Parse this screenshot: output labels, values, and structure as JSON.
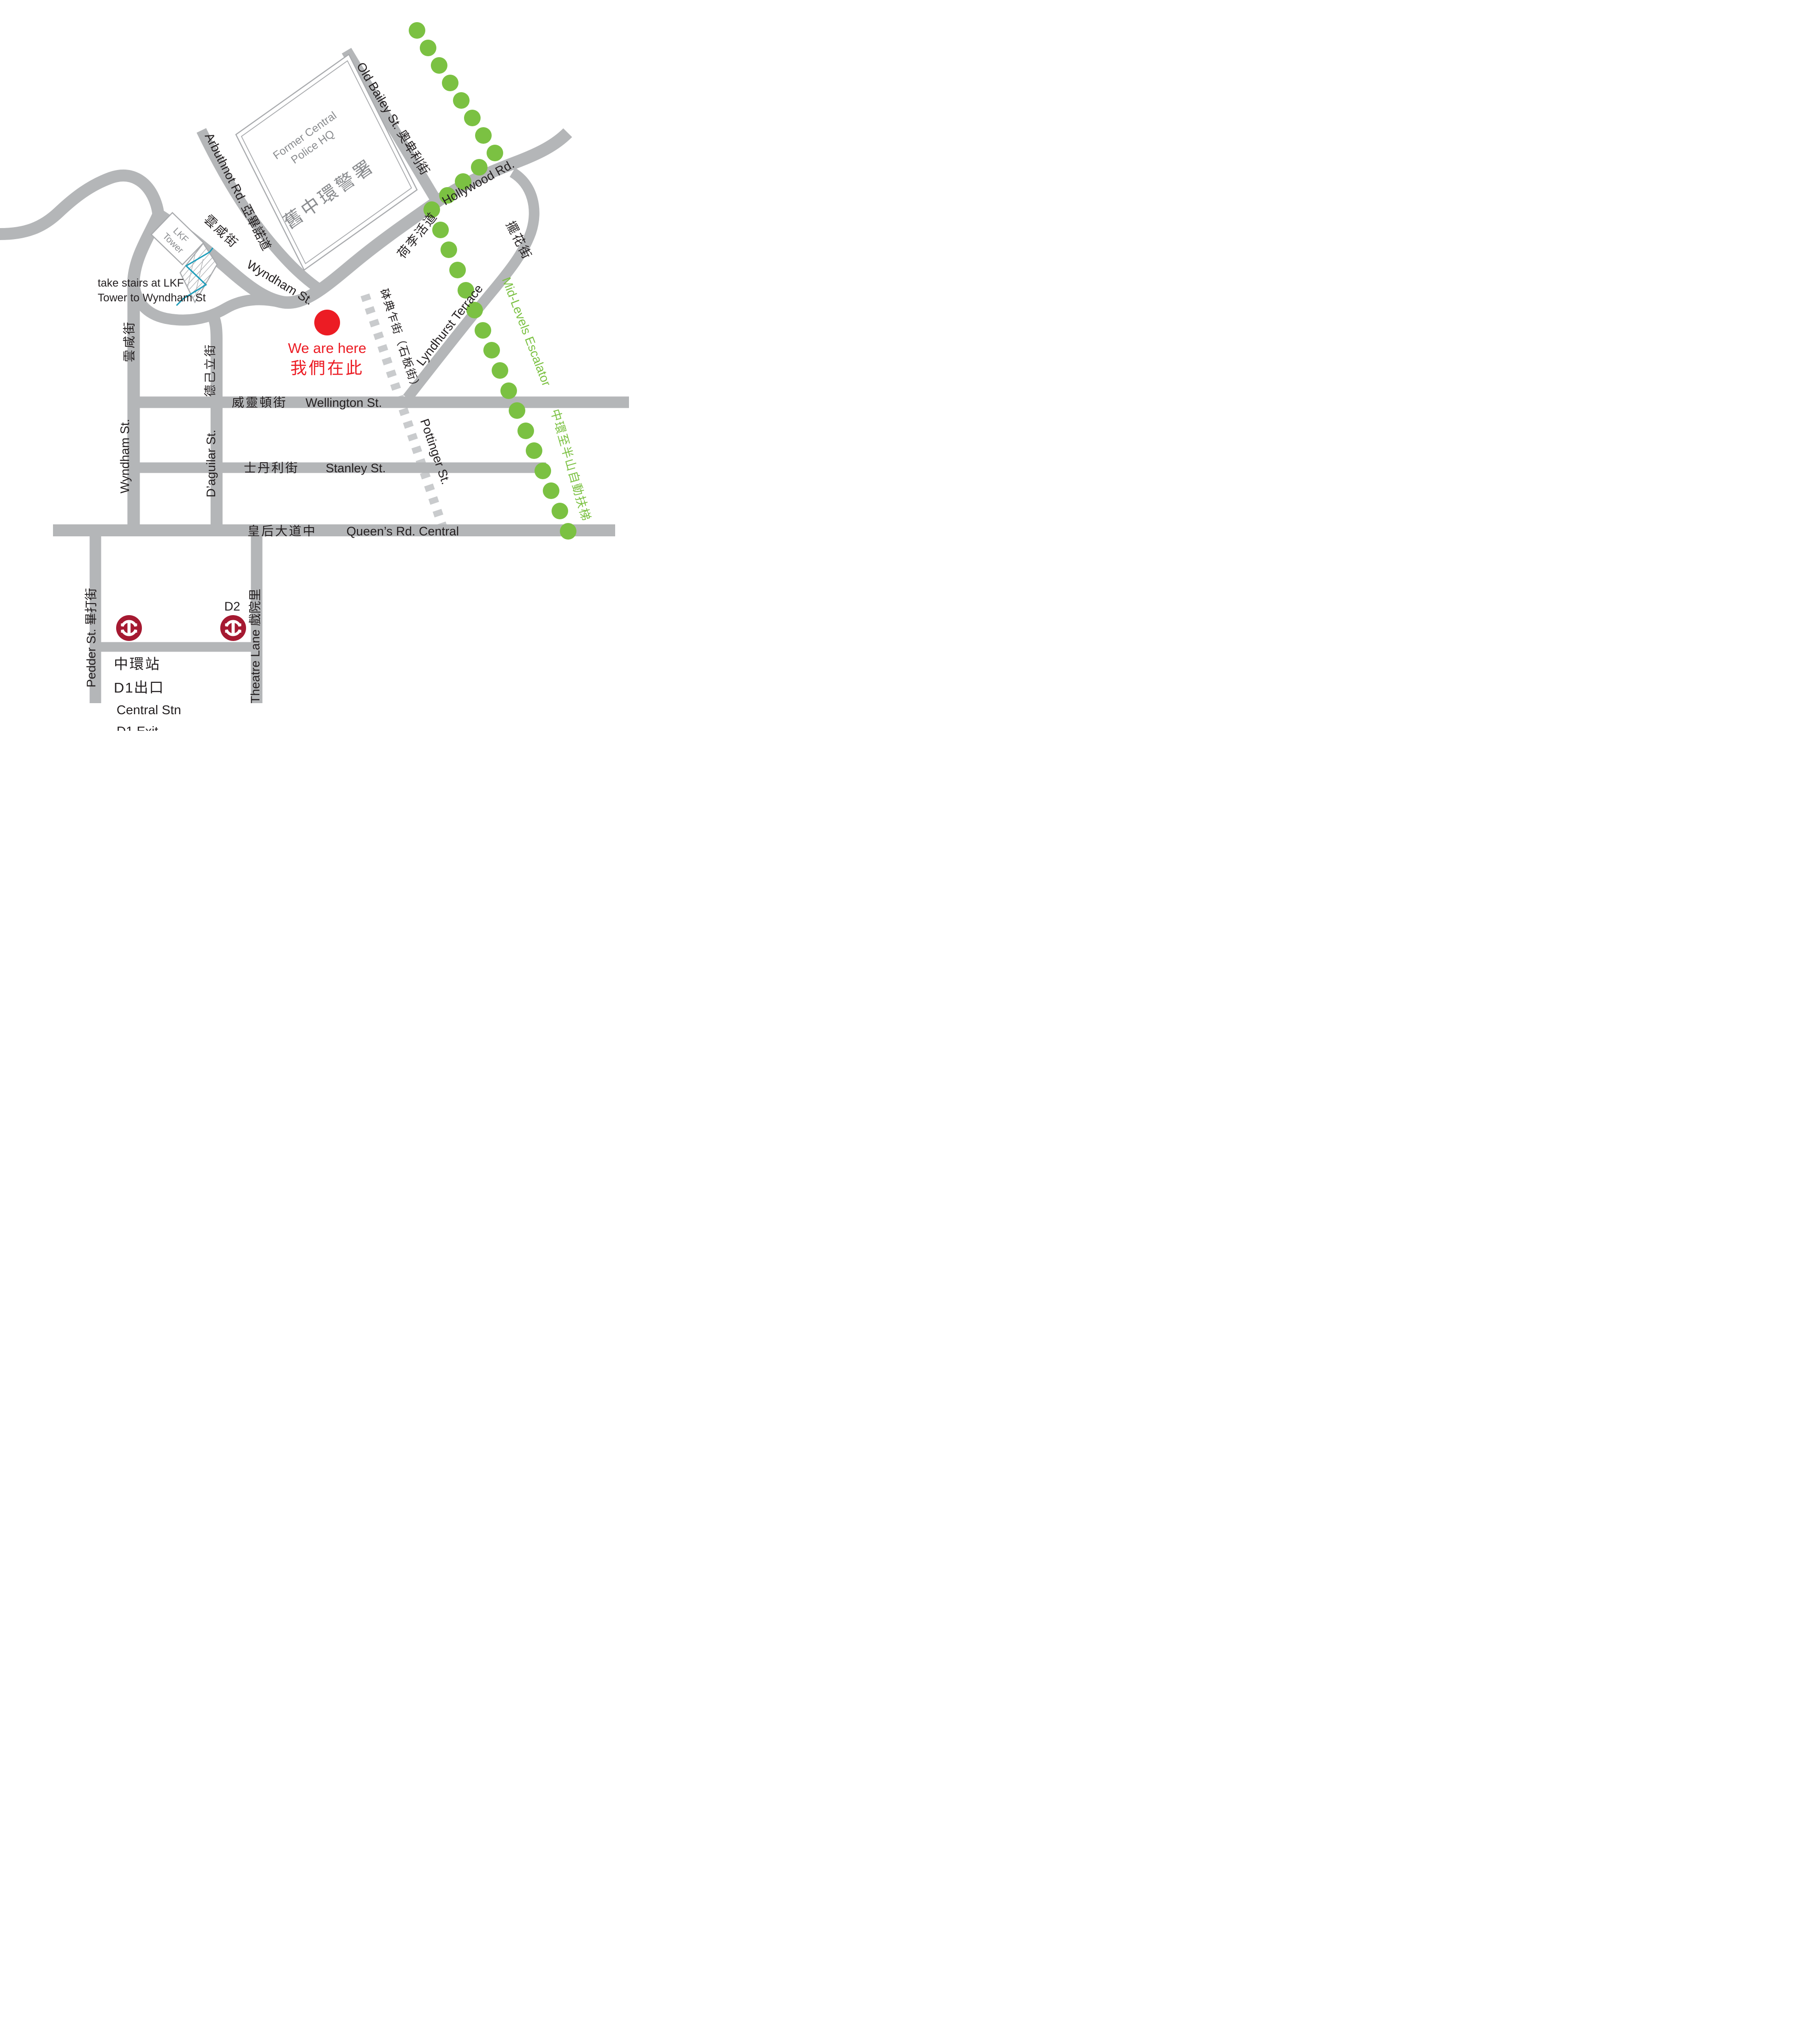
{
  "colors": {
    "road_gray": "#B4B6B8",
    "dashed_road_gray": "#C9CBCD",
    "building_outline_gray": "#A8AAAD",
    "building_text_gray": "#8A8C8F",
    "escalator_green": "#7BC142",
    "here_red": "#EC1C24",
    "mtr_red": "#A51931",
    "stairs_teal": "#1E9EBB",
    "label_black": "#231F20"
  },
  "labels": {
    "old_bailey": "Old Bailey St. 奧卑利街",
    "former_central_line1": "Former Central",
    "former_central_line2": "Police HQ",
    "former_central_zh": "舊中環警署",
    "arbuthnot": "Arbuthnot Rd. 亞畢諾道",
    "wyndham_zh_upper": "雲咸街",
    "hollywood_en": "Hollywood Rd.",
    "hollywood_zh": "荷李活道",
    "lyndhurst_zh": "擺花街",
    "lkf_line1": "LKF",
    "lkf_line2": "Tower",
    "stairs_note_line1": "take stairs at LKF",
    "stairs_note_line2": "Tower to Wyndham St",
    "wyndham_curve": "Wyndham St.",
    "here_en": "We are here",
    "here_zh": "我們在此",
    "pottinger_zh": "砵典乍街（石板街）",
    "lyndhurst_en": "Lyndhurst Terrace",
    "escalator_en": "Mid-Levels Escalator",
    "escalator_zh": "中環至半山自動扶梯",
    "wyndham_zh_vertical": "雲咸街",
    "wyndham_en_vertical": "Wyndham St.",
    "daguilar_zh": "德己立街",
    "daguilar_en": "D’aguilar St.",
    "wellington_zh": "威靈頓街",
    "wellington_en": "Wellington St.",
    "stanley_zh": "士丹利街",
    "stanley_en": "Stanley St.",
    "pottinger_en": "Pottinger St.",
    "queens_zh": "皇后大道中",
    "queens_en": "Queen’s Rd. Central",
    "pedder": "Pedder St. 畢打街",
    "theatre": "Theatre Lane 戲院里",
    "d2": "D2",
    "station_zh1": "中環站",
    "station_zh2": "D1出口",
    "station_en1": "Central Stn",
    "station_en2": "D1 Exit"
  }
}
